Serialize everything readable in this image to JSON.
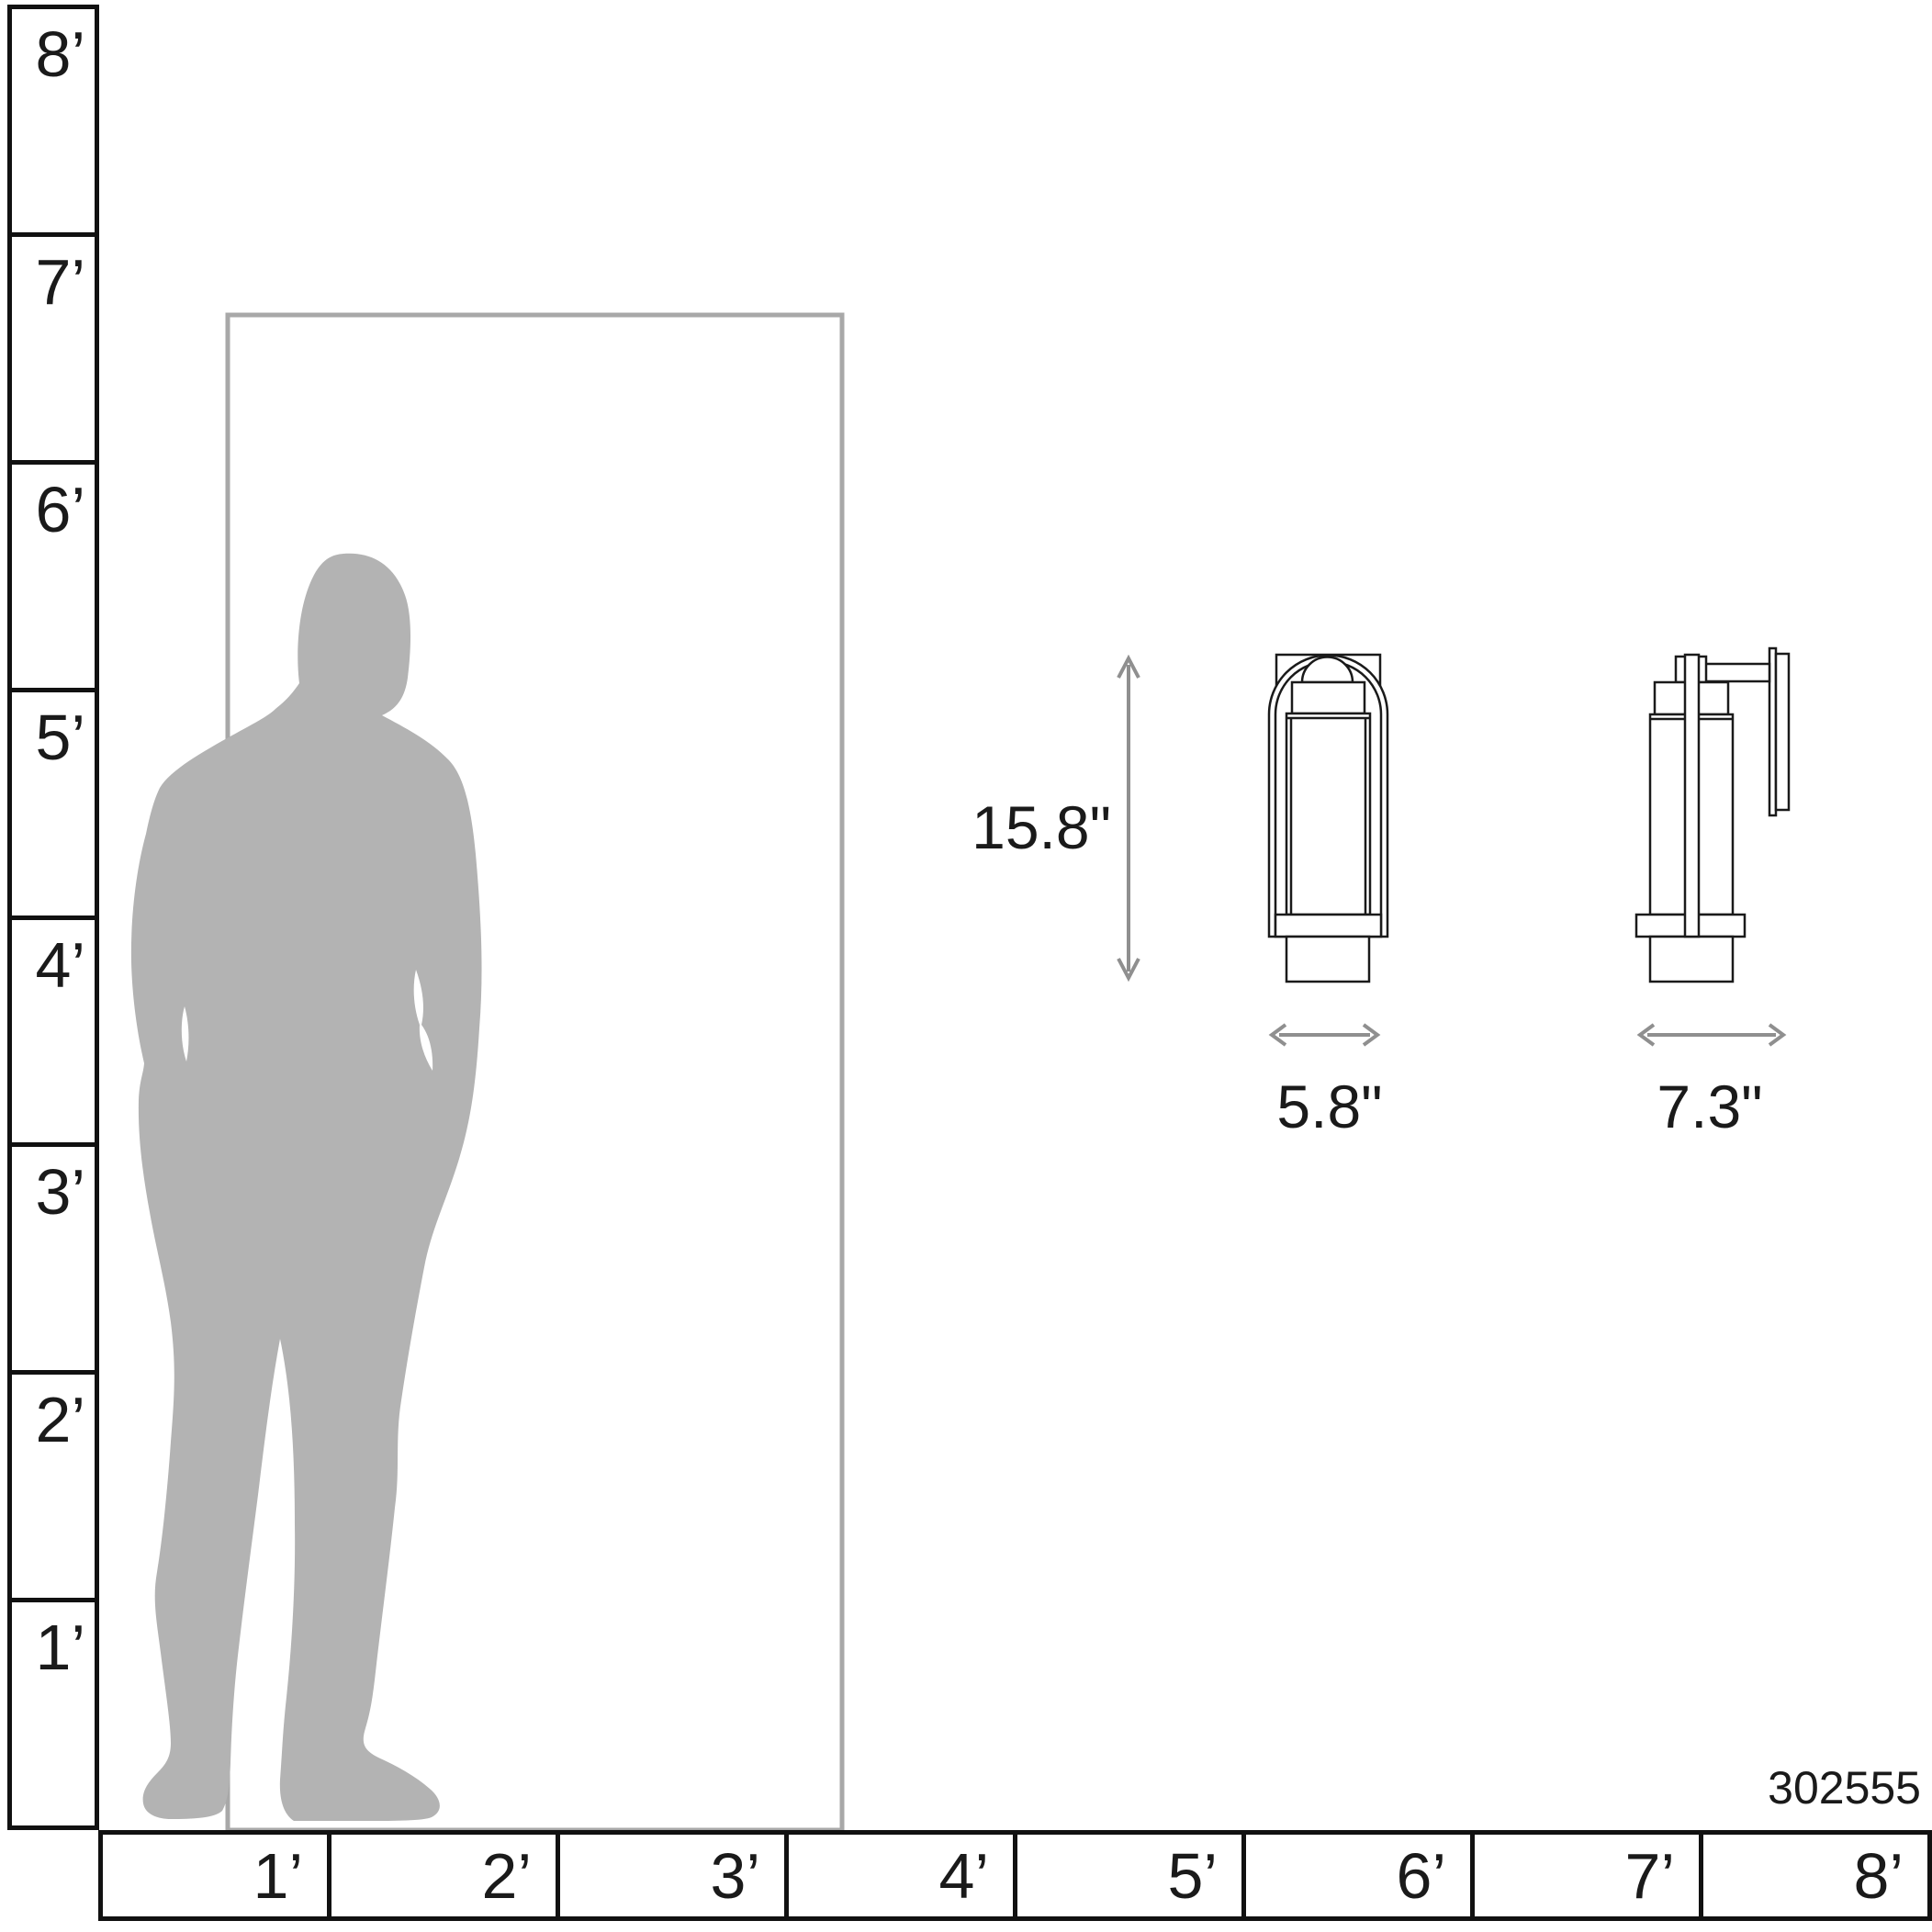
{
  "diagram": {
    "type": "product-scale-diagram",
    "product_number": "302555",
    "dimensions": {
      "height_label": "15.8\"",
      "width_label": "5.8\"",
      "depth_label": "7.3\""
    },
    "vertical_ruler": {
      "unit": "feet",
      "labels": [
        "8’",
        "7’",
        "6’",
        "5’",
        "4’",
        "3’",
        "2’",
        "1’"
      ]
    },
    "horizontal_ruler": {
      "unit": "feet",
      "labels": [
        "1’",
        "2’",
        "3’",
        "4’",
        "5’",
        "6’",
        "7’",
        "8’"
      ]
    },
    "colors": {
      "silhouette": "#b3b3b3",
      "door_outline": "#a8a8a8",
      "dimension_arrow": "#8f8f8f",
      "drawing_line": "#1a1a1a",
      "ruler_line": "#111111"
    }
  }
}
